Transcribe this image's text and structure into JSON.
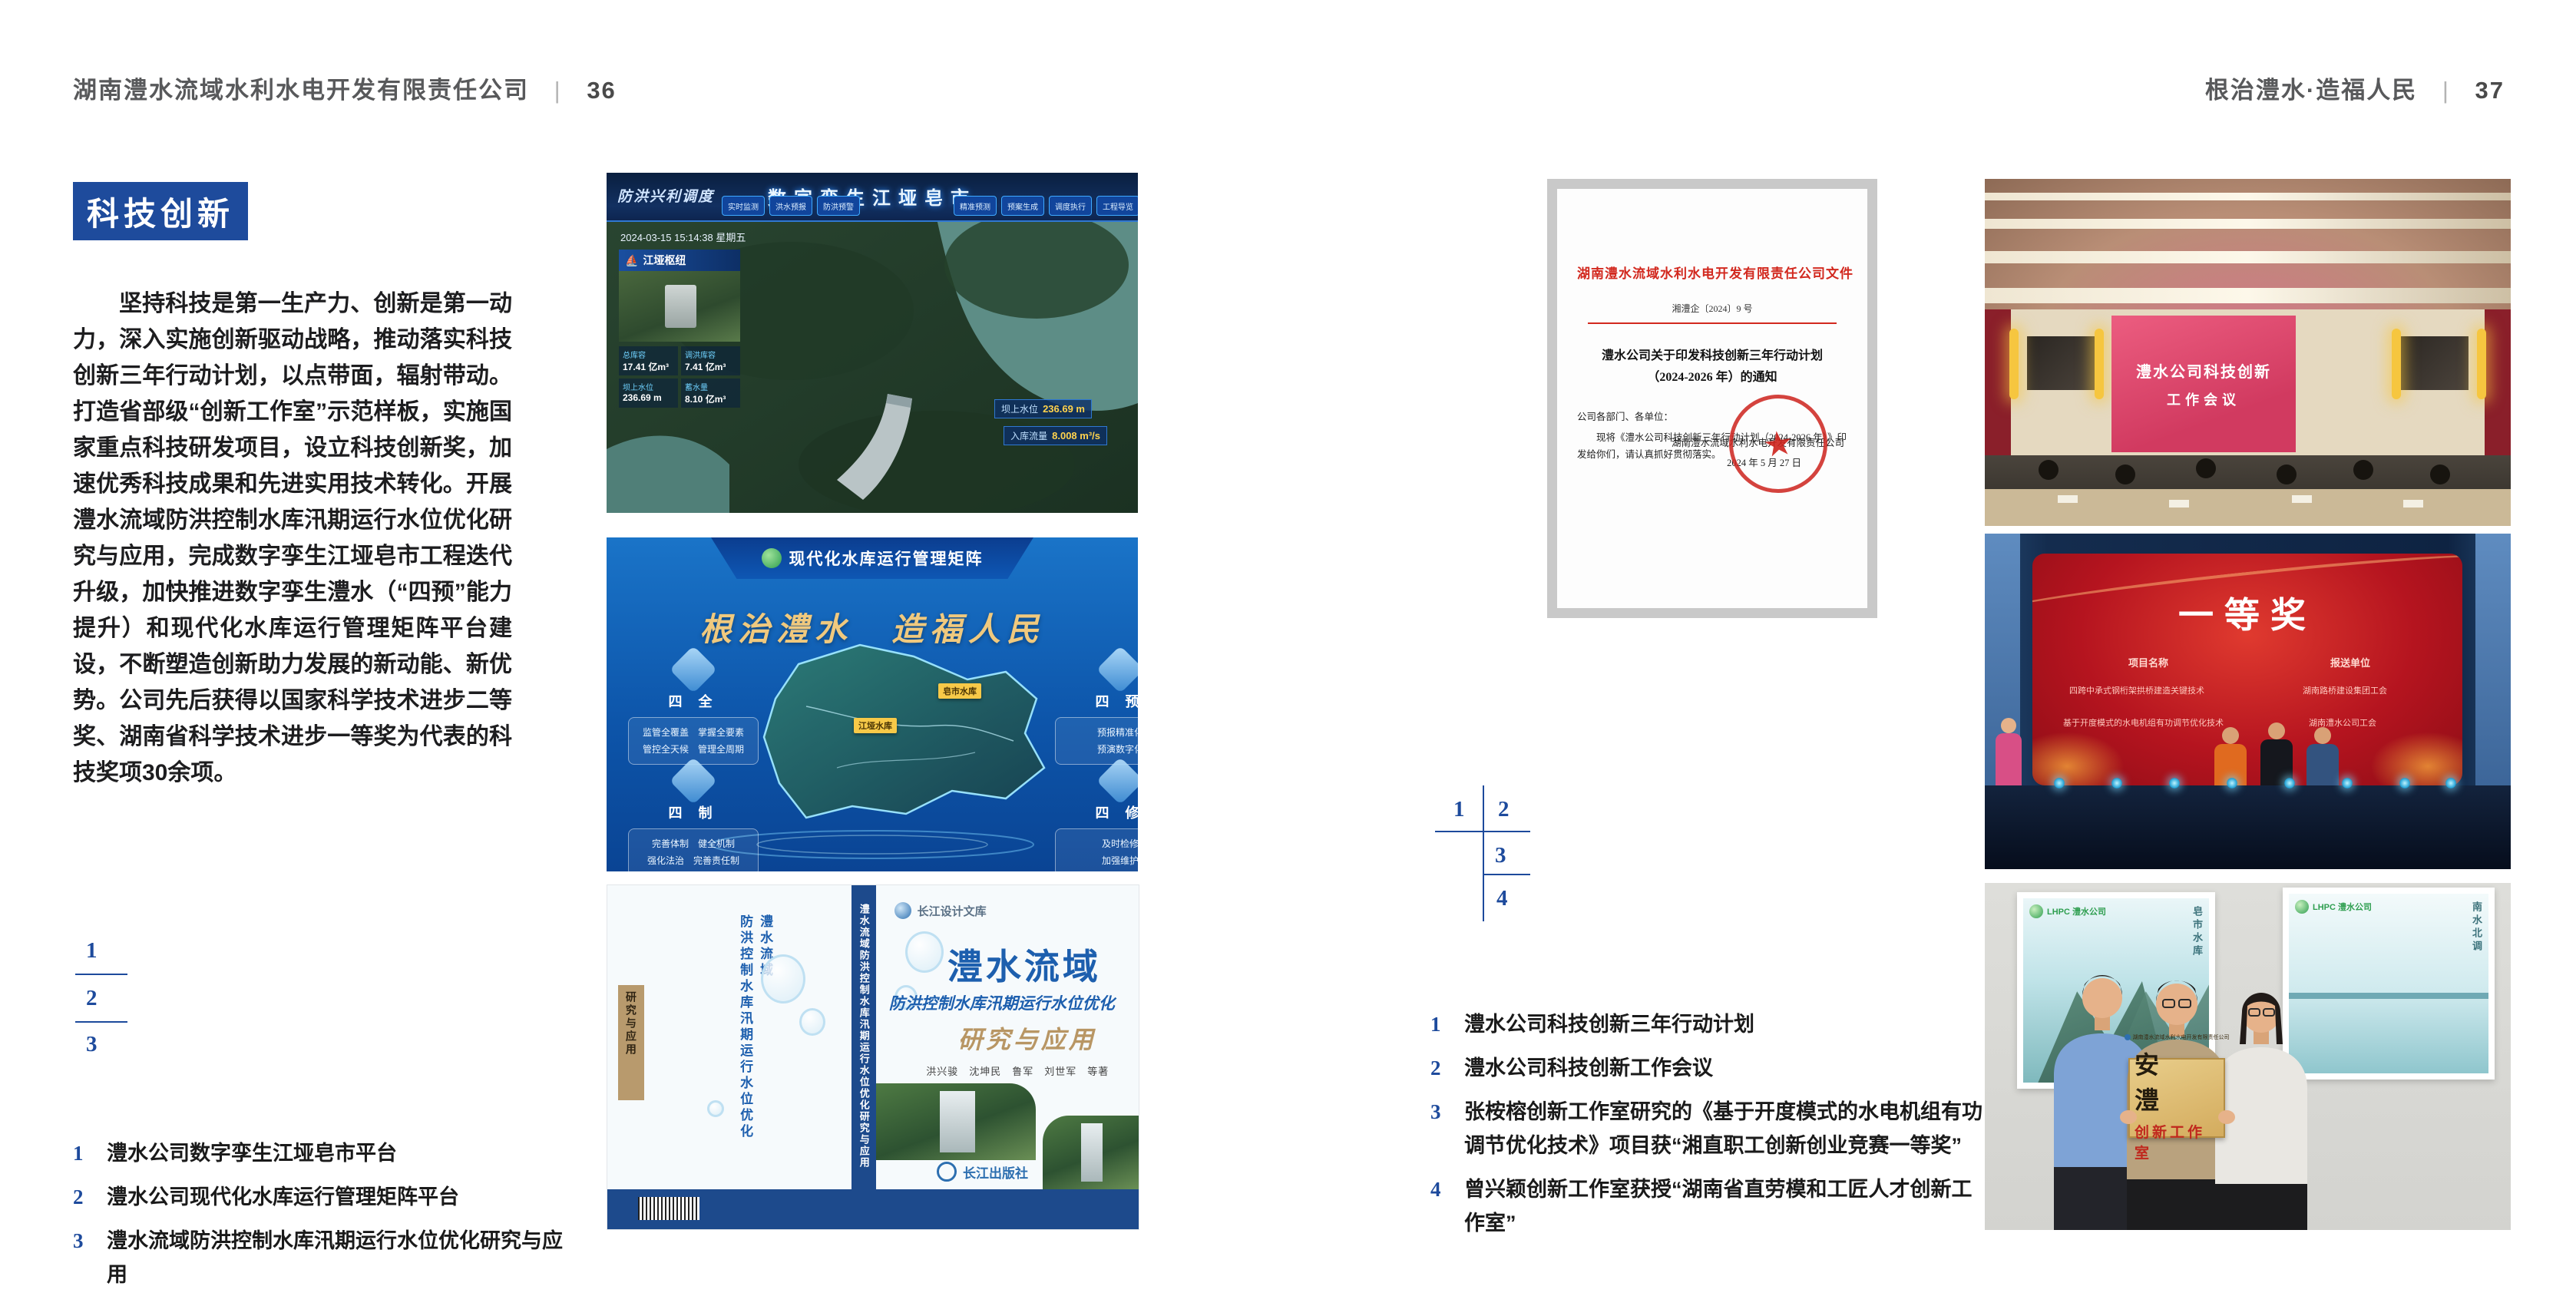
{
  "page_left": {
    "header": {
      "title": "湖南澧水流域水利水电开发有限责任公司",
      "separator": "|",
      "page_number": "36"
    },
    "section_badge": "科技创新",
    "body_paragraph": "坚持科技是第一生产力、创新是第一动力，深入实施创新驱动战略，推动落实科技创新三年行动计划，以点带面，辐射带动。打造省部级“创新工作室”示范样板，实施国家重点科技研发项目，设立科技创新奖，加速优秀科技成果和先进实用技术转化。开展澧水流域防洪控制水库汛期运行水位优化研究与应用，完成数字孪生江垭皂市工程迭代升级，加快推进数字孪生澧水（“四预”能力提升）和现代化水库运行管理矩阵平台建设，不断塑造创新助力发展的新动能、新优势。公司先后获得以国家科学技术进步二等奖、湖南省科学技术进步一等奖为代表的科技奖项30余项。",
    "figure_index": {
      "n1": "1",
      "n2": "2",
      "n3": "3"
    },
    "captions": [
      {
        "num": "1",
        "text": "澧水公司数字孪生江垭皂市平台"
      },
      {
        "num": "2",
        "text": "澧水公司现代化水库运行管理矩阵平台"
      },
      {
        "num": "3",
        "text": "澧水流域防洪控制水库汛期运行水位优化研究与应用"
      }
    ],
    "figures": {
      "dashboard": {
        "brand": "防洪兴利调度",
        "title": "数字孪生江垭皂市",
        "tabs": [
          "实时监测",
          "洪水预报",
          "防洪预警",
          "精准预测",
          "预案生成",
          "调度执行",
          "工程导览"
        ],
        "datetime": "2024-03-15 15:14:38 星期五",
        "panel_title": "江垭枢纽",
        "panel_stats": [
          {
            "label": "总库容",
            "value": "17.41 亿m³"
          },
          {
            "label": "调洪库容",
            "value": "7.41 亿m³"
          },
          {
            "label": "坝上水位",
            "value": "236.69 m"
          },
          {
            "label": "蓄水量",
            "value": "8.10 亿m³"
          }
        ],
        "chips": [
          {
            "label": "坝上水位",
            "value": "236.69 m"
          },
          {
            "label": "入库流量",
            "value": "8.008 m³/s"
          }
        ]
      },
      "matrix": {
        "title": "现代化水库运行管理矩阵",
        "slogan": "根治澧水　造福人民",
        "groups_left": [
          {
            "name": "四 全",
            "line1": "监管全覆盖　掌握全要素",
            "line2": "管控全天候　管理全周期"
          },
          {
            "name": "四 制",
            "line1": "完善体制　健全机制",
            "line2": "强化法治　完善责任制"
          }
        ],
        "groups_right": [
          {
            "name": "四 预",
            "line1": "预报精准化",
            "line2": "预演数字化"
          },
          {
            "name": "四 修",
            "line1": "及时检修",
            "line2": "加强维护"
          }
        ],
        "map_tags": [
          "江垭水库",
          "皂市水库"
        ]
      },
      "book": {
        "series": "长江设计文库",
        "title_main": "澧水流域",
        "title_sub": "防洪控制水库汛期运行水位优化",
        "title_tail": "研究与应用",
        "authors": "洪兴骏　沈坤民　鲁军　刘世军　等著",
        "publisher": "长江出版社",
        "spine_text": "澧水流域防洪控制水库汛期运行水位优化研究与应用",
        "back_vertical_title": "澧水流域\n防洪控制水库汛期运行水位优化",
        "back_tag": "研究与应用"
      }
    }
  },
  "page_right": {
    "header": {
      "title": "根治澧水·造福人民",
      "separator": "|",
      "page_number": "37"
    },
    "figure_index": {
      "n1": "1",
      "n2": "2",
      "n3": "3",
      "n4": "4"
    },
    "captions": [
      {
        "num": "1",
        "text": "澧水公司科技创新三年行动计划"
      },
      {
        "num": "2",
        "text": "澧水公司科技创新工作会议"
      },
      {
        "num": "3",
        "text": "张桉榕创新工作室研究的《基于开度模式的水电机组有功调节优化技术》项目获“湘直职工创新创业竞赛一等奖”"
      },
      {
        "num": "4",
        "text": "曾兴颖创新工作室获授“湖南省直劳模和工匠人才创新工作室”"
      }
    ],
    "figures": {
      "document": {
        "header": "湖南澧水流域水利水电开发有限责任公司文件",
        "number": "湘澧企〔2024〕9 号",
        "title": "澧水公司关于印发科技创新三年行动计划\n（2024-2026 年）的通知",
        "salutation": "公司各部门、各单位：",
        "body": "现将《澧水公司科技创新三年行动计划（2024-2026 年）》印发给你们，请认真抓好贯彻落实。",
        "signer": "湖南澧水流域水利水电开发有限责任公司",
        "date": "2024 年 5 月 27 日",
        "seal_star": "★"
      },
      "meeting": {
        "screen_line1": "澧水公司科技创新",
        "screen_line2": "工作会议"
      },
      "award": {
        "headline": "一等奖",
        "col_project": "项目名称",
        "col_unit": "报送单位",
        "rows": [
          {
            "project": "四跨中承式钢桁架拱桥建造关键技术",
            "unit": "湖南路桥建设集团工会"
          },
          {
            "project": "基于开度模式的水电机组有功调节优化技术",
            "unit": "湖南澧水公司工会"
          }
        ]
      },
      "plaque": {
        "org": "湖南澧水流域水利水电开发有限责任公司",
        "name": "安　澧",
        "subtitle": "创新工作室",
        "logo": "LHPC 澧水公司"
      }
    }
  },
  "colors": {
    "accent_blue": "#1e4b9c",
    "doc_red": "#d2281e",
    "gold": "#d4ac5e"
  }
}
